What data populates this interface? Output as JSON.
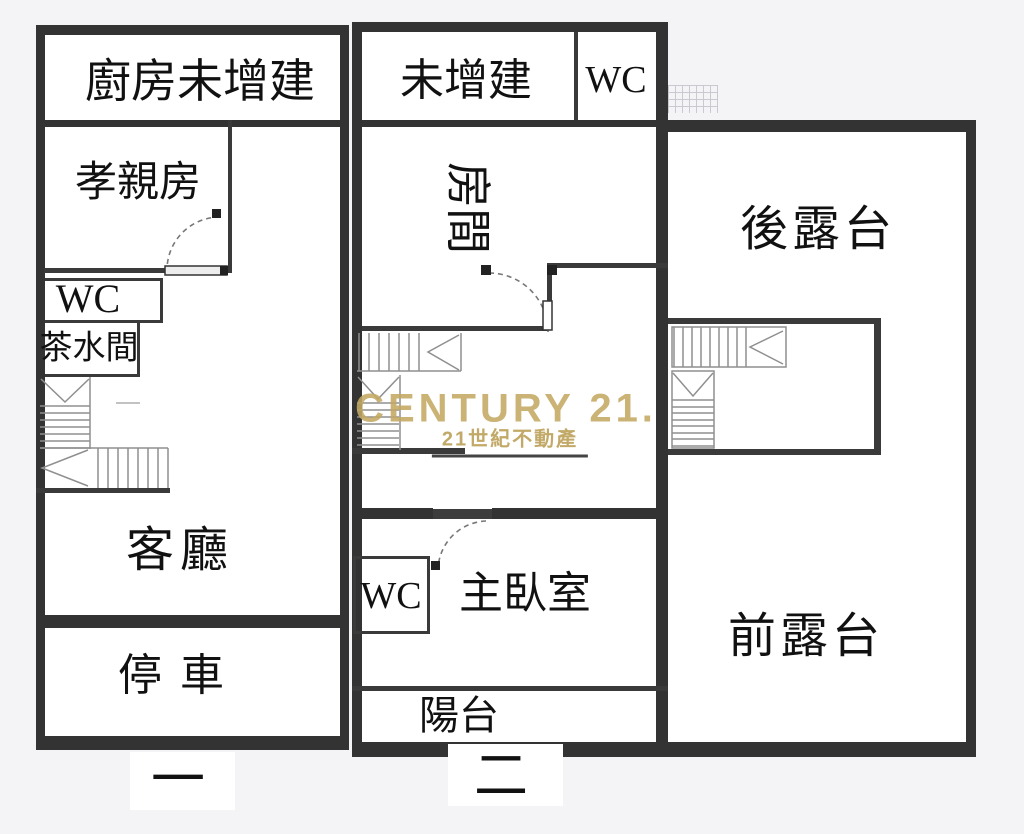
{
  "page": {
    "background": "#f4f4f7",
    "plan_background": "#ffffff",
    "wall_color": "#333333",
    "watermark_gold": "#c3a963"
  },
  "floor1": {
    "floor_label": "一",
    "kitchen_unbuilt": "廚房未增建",
    "parents_room": "孝親房",
    "wc": "WC",
    "pantry": "茶水間",
    "living_room": "客廳",
    "parking": "停車"
  },
  "floor2": {
    "floor_label": "二",
    "unbuilt": "未增建",
    "wc_upper": "WC",
    "room": "房間",
    "wc": "WC",
    "master_bedroom": "主臥室",
    "balcony": "陽台"
  },
  "terrace": {
    "rear": "後露台",
    "front": "前露台"
  },
  "watermark": {
    "brand": "CENTURY 21.",
    "subtext": "21世紀不動產"
  }
}
